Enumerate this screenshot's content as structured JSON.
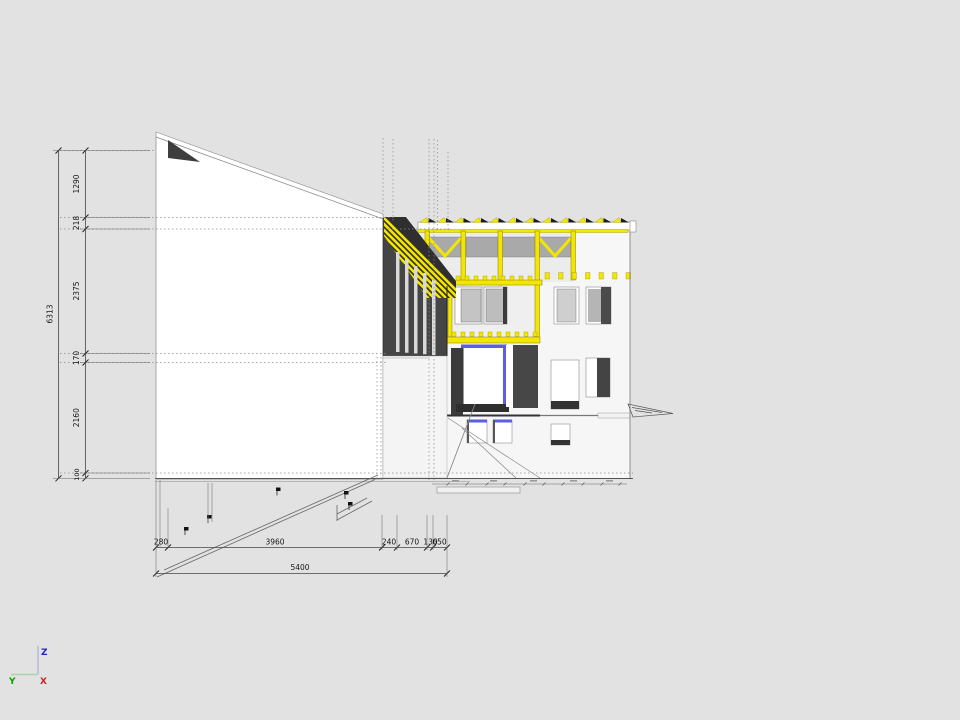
{
  "canvas": {
    "background": "#e2e2e2"
  },
  "colors": {
    "yellow": "#f3e600",
    "yellow_dark": "#9e9100",
    "blue": "#5d5de0",
    "wall_dark": "#454545",
    "wall_darker": "#2f2f2f",
    "reveal_dark": "#3b3b3b",
    "block_dark": "#474747",
    "sill_dark": "#2e2e2e",
    "glass_gray": "#bdbdbd",
    "glass_light": "#cfcfcf",
    "panel_gray": "#a9a9a9",
    "white": "#ffffff"
  },
  "dimensions": {
    "vertical": {
      "total": "6313",
      "segments": [
        "1290",
        "218",
        "2375",
        "170",
        "2160",
        "100"
      ]
    },
    "horizontal": {
      "total": "5400",
      "segments": [
        "280",
        "3960",
        "240",
        "670",
        "130",
        "650"
      ]
    }
  },
  "axis_gizmo": {
    "z_label": "Z",
    "y_label": "Y",
    "x_label": "X"
  }
}
